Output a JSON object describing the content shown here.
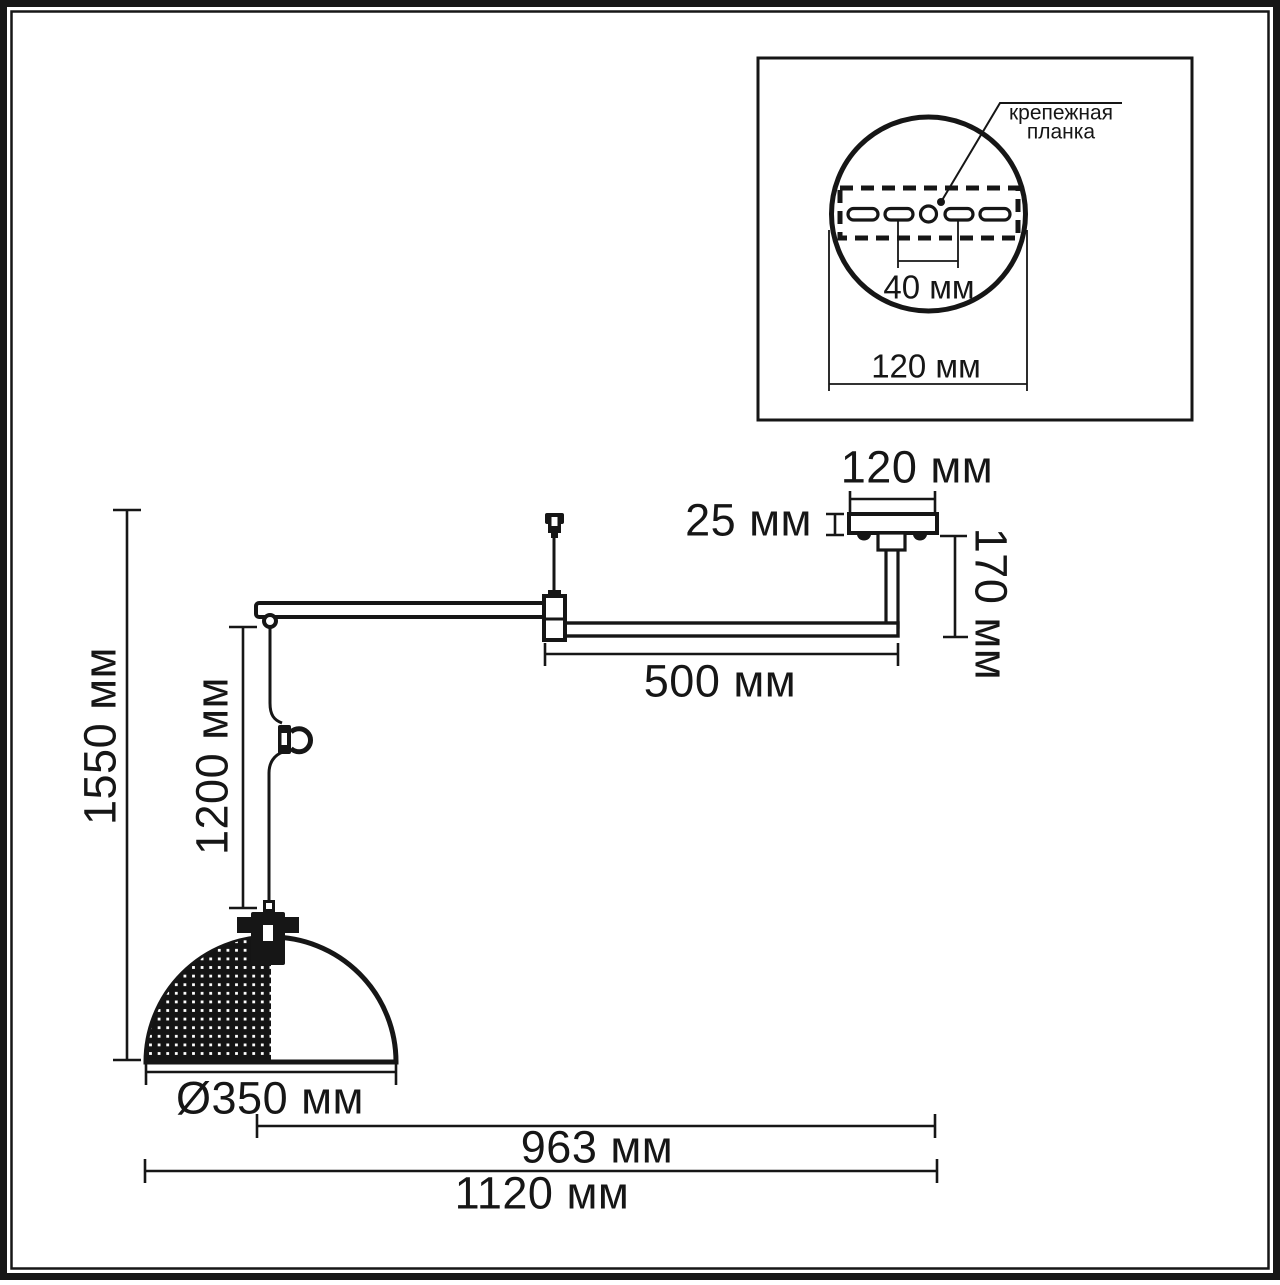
{
  "inset": {
    "callout_line1": "крепежная",
    "callout_line2": "планка",
    "slot_spacing": "40 мм",
    "plate_width": "120 мм"
  },
  "dimensions": {
    "canopy_width": "120 мм",
    "canopy_height": "25 мм",
    "stem_drop": "170 мм",
    "arm_length": "500 мм",
    "total_height": "1550 мм",
    "cord_length": "1200 мм",
    "shade_diameter": "Ø350 мм",
    "reach_to_shade_center": "963 мм",
    "total_width": "1120 мм"
  },
  "colors": {
    "line": "#161616",
    "background": "#ffffff"
  }
}
